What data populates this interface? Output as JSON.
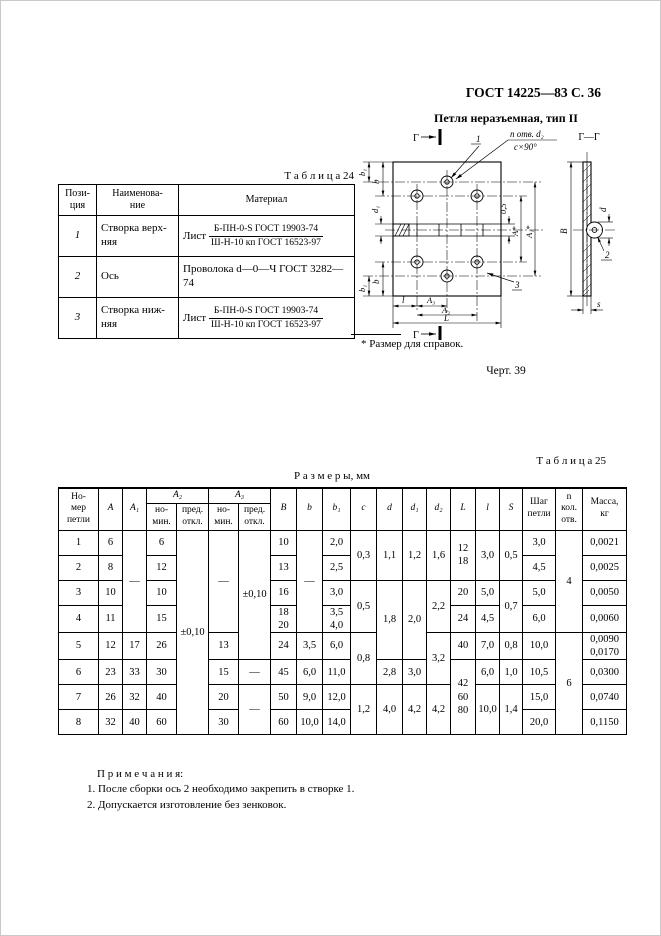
{
  "page": {
    "header": "ГОСТ 14225—83 С. 36",
    "figure_title": "Петля неразъемная, тип II",
    "footnote": "* Размер для справок.",
    "figure_caption": "Черт. 39"
  },
  "table24": {
    "caption": "Т а б л и ц а  24",
    "headers": {
      "pos": "Пози-\nция",
      "name": "Наименова-\nние",
      "material": "Материал"
    },
    "rows": [
      {
        "pos": "1",
        "name": "Створка верх-\nняя",
        "material_prefix": "Лист",
        "material_num": "Б-ПН-0-S ГОСТ 19903-74",
        "material_den": "Ш-Н-10 кп ГОСТ 16523-97"
      },
      {
        "pos": "2",
        "name": "Ось",
        "material": "Проволока d—0—Ч ГОСТ 3282—74"
      },
      {
        "pos": "3",
        "name": "Створка ниж-\nняя",
        "material_prefix": "Лист",
        "material_num": "Б-ПН-0-S ГОСТ 19903-74",
        "material_den": "Ш-Н-10 кп ГОСТ 16523-97"
      }
    ]
  },
  "drawing": {
    "labels": {
      "section_mark": "Г",
      "section_title": "Г—Г",
      "part_1": "1",
      "part_2": "2",
      "part_3": "3",
      "holes_note_line1": "n отв. d₂",
      "holes_note_line2": "c×90°",
      "dim_b": "b",
      "dim_b1": "b₁",
      "dim_d1": "d₁",
      "dim_gap": "0,5",
      "dim_A": "А*",
      "dim_A1": "А₁*",
      "dim_l": "l",
      "dim_A3": "А₃",
      "dim_A2": "А₂",
      "dim_L": "L",
      "dim_B": "B",
      "dim_d": "d",
      "dim_s": "s"
    }
  },
  "table25": {
    "caption": "Т а б л и ц а  25",
    "title": "Р а з м е р ы,  мм",
    "header_rows": [
      [
        {
          "t": "Но-\nмер\nпетли",
          "rs": 2
        },
        {
          "t": "A",
          "rs": 2,
          "i": 1
        },
        {
          "t": "A₁",
          "rs": 2,
          "i": 1
        },
        {
          "t": "A₂",
          "cs": 2,
          "i": 1
        },
        {
          "t": "A₃",
          "cs": 2,
          "i": 1
        },
        {
          "t": "B",
          "rs": 2,
          "i": 1
        },
        {
          "t": "b",
          "rs": 2,
          "i": 1
        },
        {
          "t": "b₁",
          "rs": 2,
          "i": 1
        },
        {
          "t": "c",
          "rs": 2,
          "i": 1
        },
        {
          "t": "d",
          "rs": 2,
          "i": 1
        },
        {
          "t": "d₁",
          "rs": 2,
          "i": 1
        },
        {
          "t": "d₂",
          "rs": 2,
          "i": 1
        },
        {
          "t": "L",
          "rs": 2,
          "i": 1
        },
        {
          "t": "l",
          "rs": 2,
          "i": 1
        },
        {
          "t": "S",
          "rs": 2,
          "i": 1
        },
        {
          "t": "Шаг\nпетли",
          "rs": 2
        },
        {
          "t": "n\nкол.\nотв.",
          "rs": 2
        },
        {
          "t": "Масса,\nкг",
          "rs": 2
        }
      ],
      [
        {
          "t": "но-\nмин."
        },
        {
          "t": "пред.\nоткл."
        },
        {
          "t": "но-\nмин."
        },
        {
          "t": "пред.\nоткл."
        }
      ]
    ],
    "rows": [
      [
        "1",
        "6",
        {
          "t": "—",
          "rs": 4
        },
        "6",
        {
          "t": "±0,10",
          "rs": 8
        },
        {
          "t": "—",
          "rs": 4
        },
        {
          "t": "±0,10",
          "rs": 5
        },
        "10",
        {
          "t": "—",
          "rs": 4
        },
        "2,0",
        {
          "t": "0,3",
          "rs": 2
        },
        {
          "t": "1,1",
          "rs": 2
        },
        {
          "t": "1,2",
          "rs": 2
        },
        {
          "t": "1,6",
          "rs": 2
        },
        {
          "t": "12\n18",
          "rs": 2
        },
        {
          "t": "3,0",
          "rs": 2
        },
        {
          "t": "0,5",
          "rs": 2
        },
        "3,0",
        {
          "t": "4",
          "rs": 4
        },
        "0,0021"
      ],
      [
        "2",
        "8",
        "12",
        "13",
        "2,5",
        "4,5",
        "0,0025"
      ],
      [
        "3",
        "10",
        "10",
        "16",
        "3,0",
        {
          "t": "0,5",
          "rs": 2
        },
        {
          "t": "1,8",
          "rs": 3
        },
        {
          "t": "2,0",
          "rs": 3
        },
        {
          "t": "2,2",
          "rs": 2
        },
        "20",
        "5,0",
        {
          "t": "0,7",
          "rs": 2
        },
        "5,0",
        "0,0050"
      ],
      [
        "4",
        "11",
        "15",
        "18\n20",
        "3,5\n4,0",
        "24",
        "4,5",
        "6,0",
        "0,0060"
      ],
      [
        "5",
        "12",
        "17",
        "26",
        "13",
        "24",
        "3,5",
        "6,0",
        {
          "t": "0,8",
          "rs": 2
        },
        {
          "t": "3,2",
          "rs": 2
        },
        "40",
        "7,0",
        "0,8",
        "10,0",
        {
          "t": "6",
          "rs": 4
        },
        "0,0090\n0,0170"
      ],
      [
        "6",
        "23",
        "33",
        "30",
        "15",
        "—",
        "45",
        "6,0",
        "11,0",
        "2,8",
        "3,0",
        {
          "t": "42\n60\n80",
          "rs": 3
        },
        "6,0",
        "1,0",
        "10,5",
        "0,0300"
      ],
      [
        "7",
        "26",
        "32",
        "40",
        "20",
        {
          "t": "—",
          "rs": 2
        },
        "50",
        "9,0",
        "12,0",
        {
          "t": "1,2",
          "rs": 2
        },
        {
          "t": "4,0",
          "rs": 2
        },
        {
          "t": "4,2",
          "rs": 2
        },
        {
          "t": "4,2",
          "rs": 2
        },
        {
          "t": "10,0",
          "rs": 2
        },
        {
          "t": "1,4",
          "rs": 2
        },
        "15,0",
        "0,0740"
      ],
      [
        "8",
        "32",
        "40",
        "60",
        "30",
        "60",
        "10,0",
        "14,0",
        "20,0",
        "0,1150"
      ]
    ]
  },
  "notes": {
    "title": "П р и м е ч а н и я:",
    "items": [
      "1. После сборки ось 2  необходимо закрепить в створке 1.",
      "2. Допускается изготовление без зенковок."
    ]
  }
}
